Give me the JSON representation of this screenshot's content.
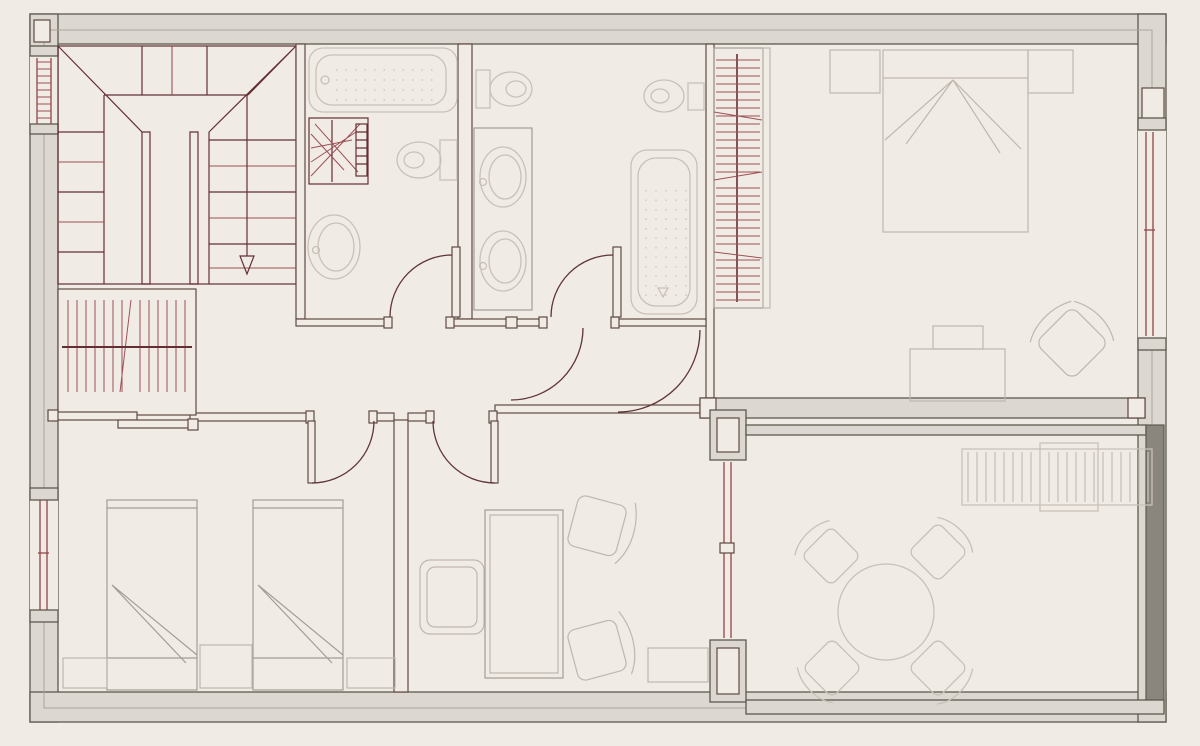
{
  "document": {
    "kind": "architectural-floor-plan",
    "visible_text": []
  },
  "palette": {
    "paper": "#f1ebe6",
    "wall_line": "#5c5b4e",
    "wall_inner": "#aaa49a",
    "wall_fill": "#dcd7d1",
    "wall_shadow": "#8b867d",
    "partition_line": "#5f4a42",
    "stair_dark": "#642f34",
    "stair_red": "#9d5156",
    "door_line": "#5e3437",
    "window_line": "#8d4547",
    "fixture_line": "#c9c1b8",
    "furniture_line": "#bfb7ae",
    "furniture_dark": "#a59d94"
  },
  "plan": {
    "rooms": [
      {
        "id": "stair-hall",
        "fixtures": [
          "u-shaped-staircase",
          "direction-down-arrow",
          "stairwell-window"
        ]
      },
      {
        "id": "hallway",
        "fixtures": [
          "coat-closet-with-rail",
          "sliding-door",
          "corridor-door"
        ]
      },
      {
        "id": "bathroom-1",
        "fixtures": [
          "bathtub",
          "towel-radiator",
          "toilet",
          "washbasin",
          "hinged-door"
        ]
      },
      {
        "id": "bathroom-2",
        "fixtures": [
          "toilet",
          "bidet",
          "double-washbasin-vanity",
          "bathtub",
          "hinged-door"
        ]
      },
      {
        "id": "main-bedroom",
        "fixtures": [
          "wardrobe-with-hangers",
          "double-bed",
          "nightstand",
          "nightstand",
          "desk",
          "armchair",
          "window",
          "hinged-door"
        ]
      },
      {
        "id": "twin-bedroom",
        "fixtures": [
          "single-bed",
          "single-bed",
          "nightstand",
          "nightstand",
          "nightstand",
          "window",
          "hinged-door"
        ]
      },
      {
        "id": "office",
        "fixtures": [
          "desk",
          "office-chair",
          "side-chair",
          "side-chair",
          "sideboard",
          "hinged-door",
          "glazed-door"
        ]
      },
      {
        "id": "terrace",
        "fixtures": [
          "round-table",
          "chair",
          "chair",
          "chair",
          "chair",
          "sun-lounger"
        ]
      }
    ]
  }
}
